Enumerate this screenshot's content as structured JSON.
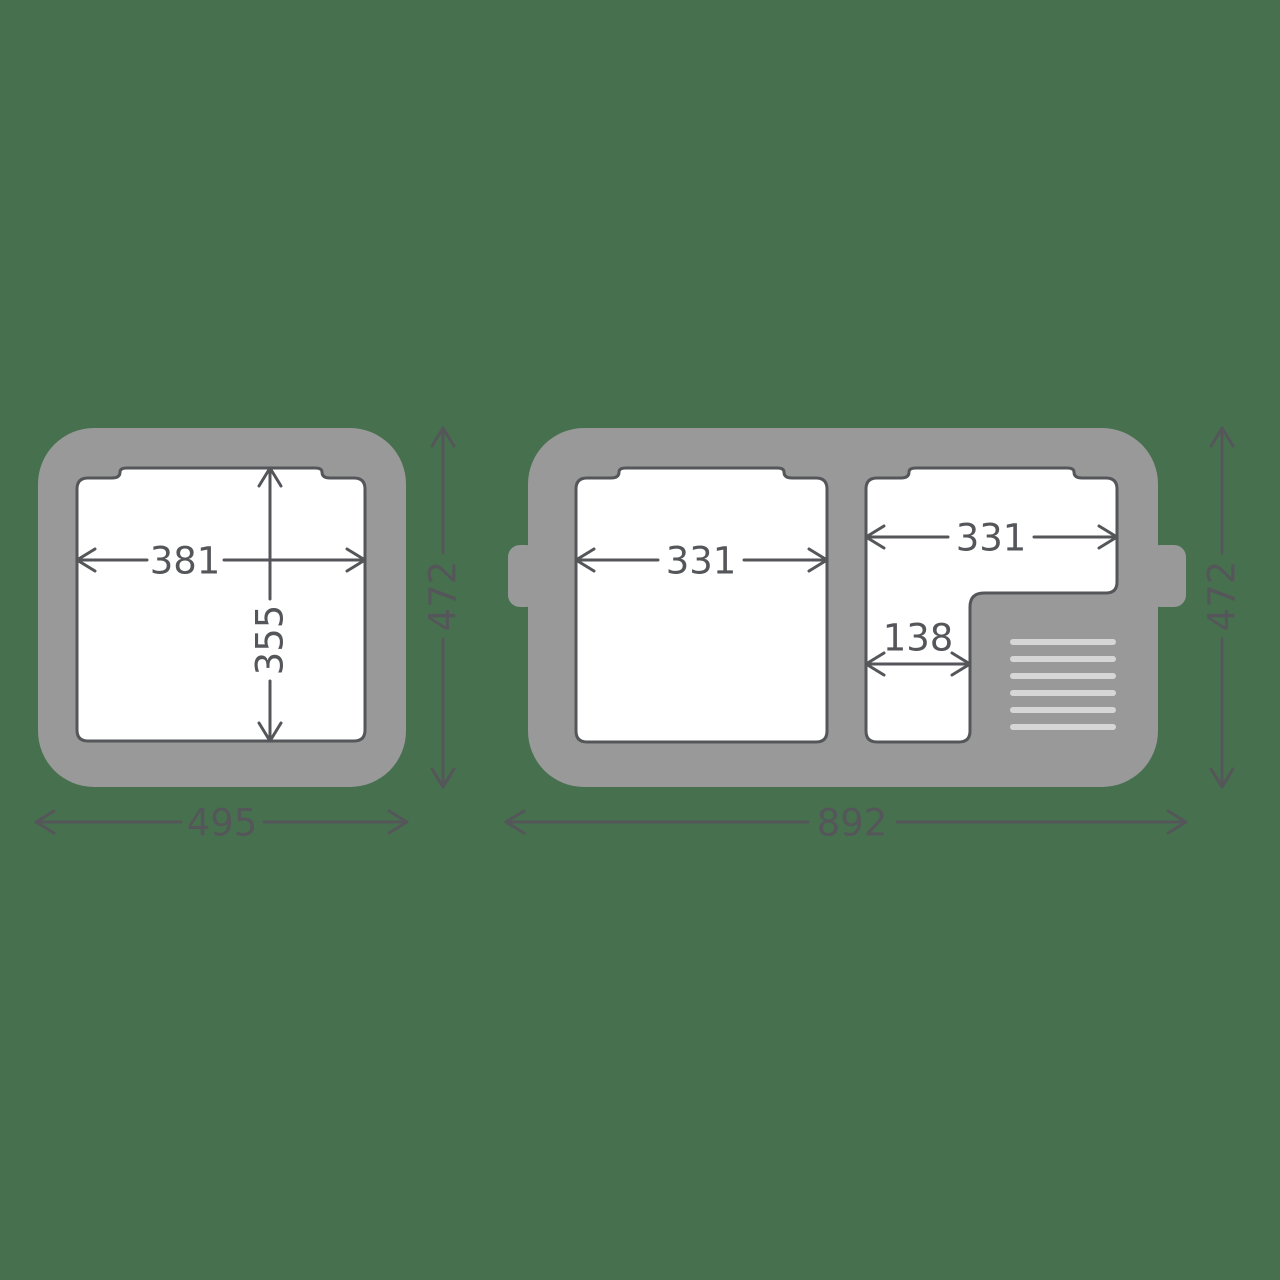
{
  "colors": {
    "background": "#47714E",
    "unit_body": "#999999",
    "line": "#54565A",
    "opening_fill": "#FFFFFF",
    "vent": "#D6D6D6"
  },
  "left_unit": {
    "opening_width_mm": "381",
    "opening_depth_mm": "355",
    "overall_width_mm": "495",
    "overall_depth_mm": "472"
  },
  "right_unit": {
    "left_compartment_width_mm": "331",
    "right_compartment_width_mm": "331",
    "right_compartment_narrow_width_mm": "138",
    "overall_width_mm": "892",
    "overall_depth_mm": "472"
  }
}
